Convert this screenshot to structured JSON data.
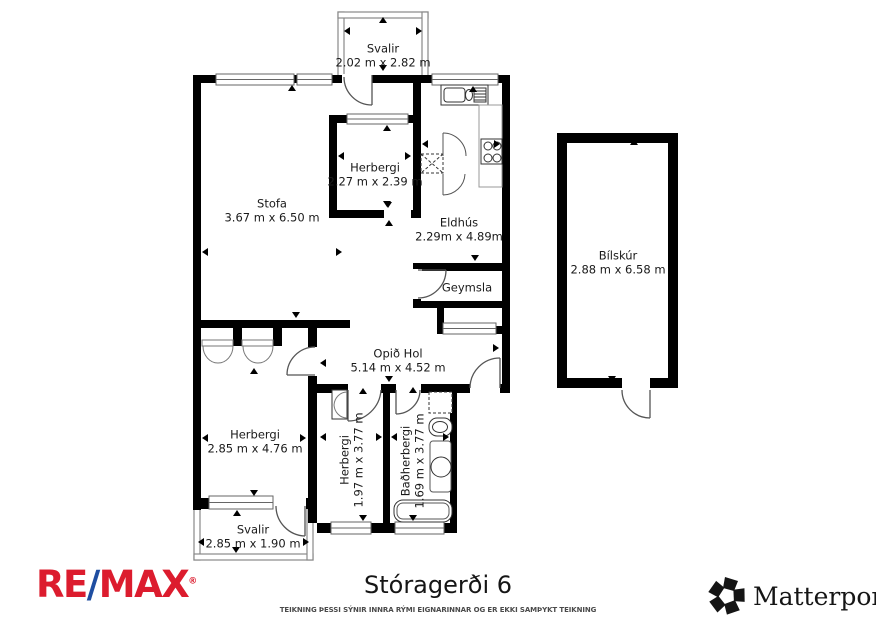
{
  "page": {
    "title": "Stóragerði 6",
    "disclaimer": "TEIKNING ÞESSI SÝNIR INNRA RÝMI EIGNARINNAR OG ER EKKI SAMÞYKT TEIKNING"
  },
  "branding": {
    "remax": {
      "part1": "RE",
      "slash": "/",
      "part2": "MAX",
      "reg": "®",
      "red": "#dc1c2e",
      "blue": "#1f4ea1"
    },
    "matterport": {
      "label": "Matterport",
      "reg": "®",
      "color": "#151515"
    }
  },
  "colors": {
    "wall": "#000000",
    "door_arc": "#555555",
    "balcony_wall": "#888888",
    "label_text": "#1a1a1a"
  },
  "rooms": {
    "svalir_top": {
      "name": "Svalir",
      "dims": "2.02 m x 2.82 m"
    },
    "stofa": {
      "name": "Stofa",
      "dims": "3.67 m x 6.50 m"
    },
    "herbergi_small": {
      "name": "Herbergi",
      "dims": "2.27 m x 2.39 m"
    },
    "eldhus": {
      "name": "Eldhús",
      "dims": "2.29m x 4.89m"
    },
    "geymsla": {
      "name": "Geymsla"
    },
    "opid_hol": {
      "name": "Opið Hol",
      "dims": "5.14 m x 4.52 m"
    },
    "herbergi_left": {
      "name": "Herbergi",
      "dims": "2.85 m x 4.76 m"
    },
    "herbergi_mid": {
      "name": "Herbergi",
      "dims": "1.97 m x 3.77 m"
    },
    "badherbergi": {
      "name": "Baðherbergi",
      "dims": "1.69 m x 3.77 m"
    },
    "svalir_bottom": {
      "name": "Svalir",
      "dims": "2.85 m x 1.90 m"
    },
    "bilskur": {
      "name": "Bílskúr",
      "dims": "2.88 m x 6.58 m"
    }
  }
}
